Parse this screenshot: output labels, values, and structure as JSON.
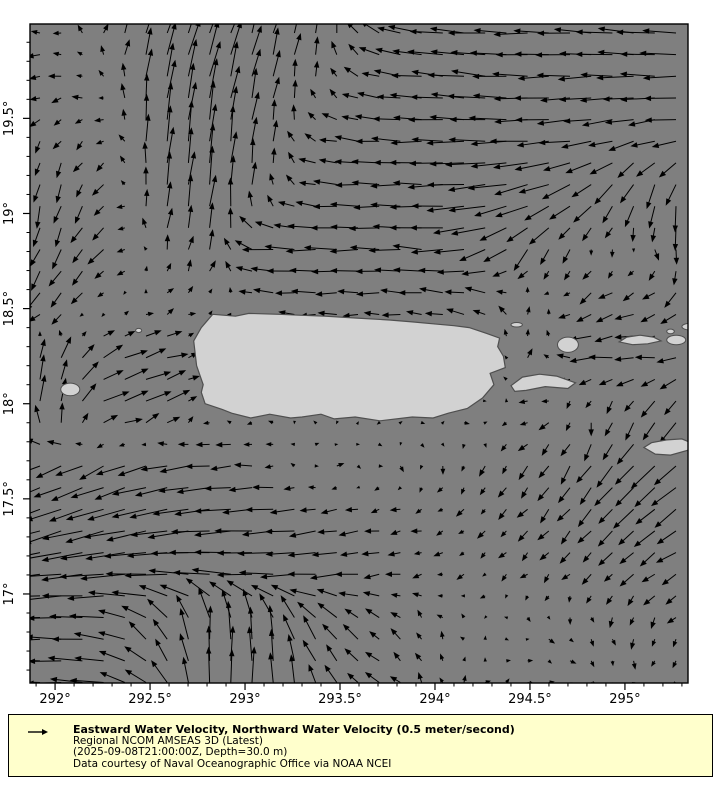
{
  "map": {
    "plot": {
      "x": 30,
      "y": 24,
      "w": 658,
      "h": 659
    },
    "extent": {
      "lon_min": 291.868,
      "lon_max": 295.332,
      "lat_min": 16.532,
      "lat_max": 19.996
    },
    "colors": {
      "ocean": "#7f7f7f",
      "land": "#d2d2d2",
      "coast": "#4f4f4f",
      "frame": "#000000",
      "arrow": "#000000",
      "tick_label": "#000000"
    }
  },
  "axes": {
    "x_ticks": [
      {
        "v": 292.0,
        "label": "292°"
      },
      {
        "v": 292.5,
        "label": "292.5°"
      },
      {
        "v": 293.0,
        "label": "293°"
      },
      {
        "v": 293.5,
        "label": "293.5°"
      },
      {
        "v": 294.0,
        "label": "294°"
      },
      {
        "v": 294.5,
        "label": "294.5°"
      },
      {
        "v": 295.0,
        "label": "295°"
      }
    ],
    "y_ticks": [
      {
        "v": 19.5,
        "label": "19.5°"
      },
      {
        "v": 19.0,
        "label": "19°"
      },
      {
        "v": 18.5,
        "label": "18.5°"
      },
      {
        "v": 18.0,
        "label": "18°"
      },
      {
        "v": 17.5,
        "label": "17.5°"
      },
      {
        "v": 17.0,
        "label": "17°"
      }
    ],
    "minor_step": 0.1,
    "font_px": 13
  },
  "field": {
    "type": "quiver",
    "units": "meter/second",
    "lon0": 292.0,
    "dlon": 0.28,
    "lat0": 19.95,
    "dlat": -0.285,
    "cols": 13,
    "rows": 13,
    "scale_px_per_ms": 42,
    "grid_spacing_px": {
      "x": 21.2,
      "y": 21.65
    },
    "u": [
      [
        -0.25,
        0.1,
        0.25,
        0.3,
        0.2,
        0.1,
        -0.4,
        -0.8,
        -0.85,
        -0.8,
        -0.85,
        -0.9,
        -0.8
      ],
      [
        -0.3,
        -0.15,
        0.15,
        0.2,
        0.15,
        -0.05,
        -0.45,
        -0.75,
        -0.85,
        -0.8,
        -0.75,
        -0.85,
        -0.8
      ],
      [
        -0.15,
        -0.2,
        0.1,
        0.1,
        0.1,
        -0.35,
        -0.6,
        -0.75,
        -0.9,
        -0.85,
        -0.7,
        -0.55,
        -0.65
      ],
      [
        -0.1,
        -0.25,
        0.1,
        0.1,
        0.0,
        -0.5,
        -0.65,
        -0.75,
        -0.95,
        -0.8,
        -0.5,
        -0.2,
        -0.05
      ],
      [
        -0.2,
        -0.35,
        0.05,
        0.1,
        -0.7,
        -0.75,
        -0.7,
        -0.75,
        -0.7,
        -0.3,
        -0.05,
        0.05,
        0.05
      ],
      [
        -0.35,
        -0.1,
        0.15,
        0.1,
        -0.4,
        -0.5,
        -0.45,
        -0.5,
        -0.45,
        0.1,
        -0.35,
        -0.4,
        -0.3
      ],
      [
        0.15,
        0.5,
        0.55,
        -0.1,
        -0.1,
        -0.1,
        -0.1,
        -0.1,
        -0.15,
        0.1,
        -0.55,
        -0.5,
        -0.4
      ],
      [
        0.05,
        0.65,
        0.6,
        -0.05,
        -0.05,
        -0.05,
        -0.05,
        0.1,
        0.15,
        -0.3,
        0.05,
        -0.2,
        -0.35
      ],
      [
        -0.6,
        -0.65,
        -0.7,
        -0.6,
        -0.3,
        0.15,
        0.1,
        0.0,
        -0.1,
        -0.2,
        -0.3,
        -0.5,
        -0.6
      ],
      [
        -0.85,
        -0.95,
        -0.9,
        -0.95,
        -0.8,
        -0.55,
        -0.35,
        -0.2,
        -0.15,
        -0.25,
        -0.3,
        -0.45,
        -0.55
      ],
      [
        -1.0,
        -1.05,
        -1.0,
        -0.9,
        -0.85,
        -0.7,
        -0.45,
        -0.2,
        -0.1,
        -0.15,
        -0.2,
        -0.3,
        -0.4
      ],
      [
        -0.8,
        -0.7,
        -0.35,
        0.0,
        -0.1,
        -0.4,
        -0.3,
        -0.1,
        -0.05,
        0.1,
        0.1,
        -0.05,
        -0.15
      ],
      [
        -0.85,
        -0.75,
        -0.4,
        0.05,
        0.0,
        -0.2,
        -0.35,
        -0.1,
        0.1,
        0.15,
        0.1,
        0.0,
        -0.1
      ]
    ],
    "v": [
      [
        0.0,
        0.3,
        0.75,
        0.8,
        0.7,
        0.5,
        0.25,
        0.1,
        0.05,
        0.0,
        0.05,
        0.08,
        0.0
      ],
      [
        -0.05,
        0.1,
        0.85,
        0.9,
        0.6,
        0.25,
        0.1,
        0.05,
        0.1,
        0.0,
        -0.05,
        0.0,
        0.0
      ],
      [
        -0.25,
        -0.1,
        0.9,
        0.95,
        0.5,
        0.1,
        0.05,
        0.0,
        0.0,
        -0.05,
        -0.1,
        -0.2,
        -0.05
      ],
      [
        -0.5,
        -0.25,
        0.7,
        0.9,
        0.3,
        0.05,
        0.0,
        0.0,
        -0.1,
        -0.25,
        -0.4,
        -0.6,
        -0.7
      ],
      [
        -0.45,
        -0.3,
        0.3,
        0.45,
        0.05,
        0.0,
        0.0,
        0.05,
        -0.2,
        -0.5,
        -0.2,
        -0.1,
        -0.55
      ],
      [
        -0.4,
        -0.05,
        0.1,
        0.05,
        0.05,
        0.0,
        0.0,
        0.05,
        0.15,
        0.25,
        -0.25,
        -0.15,
        -0.35
      ],
      [
        0.5,
        0.25,
        0.15,
        0.02,
        0.0,
        0.0,
        0.0,
        0.0,
        0.02,
        0.2,
        -0.05,
        0.0,
        -0.1
      ],
      [
        0.65,
        0.2,
        0.3,
        0.02,
        0.0,
        0.0,
        0.0,
        0.05,
        0.05,
        -0.05,
        -0.25,
        -0.4,
        -0.5
      ],
      [
        -0.25,
        -0.3,
        -0.15,
        -0.05,
        0.0,
        0.05,
        -0.05,
        -0.15,
        -0.2,
        -0.3,
        -0.45,
        -0.5,
        -0.5
      ],
      [
        -0.3,
        -0.25,
        -0.2,
        -0.1,
        -0.05,
        -0.1,
        -0.05,
        -0.05,
        -0.15,
        -0.25,
        -0.35,
        -0.4,
        -0.35
      ],
      [
        -0.1,
        -0.1,
        0.0,
        0.1,
        0.0,
        -0.05,
        -0.05,
        -0.05,
        -0.1,
        -0.15,
        -0.2,
        -0.25,
        -0.2
      ],
      [
        0.0,
        0.1,
        0.5,
        0.9,
        0.8,
        0.5,
        0.25,
        0.2,
        0.05,
        -0.05,
        -0.15,
        -0.25,
        -0.15
      ],
      [
        0.0,
        0.1,
        0.45,
        0.85,
        0.8,
        0.45,
        0.2,
        0.2,
        0.1,
        0.0,
        -0.1,
        -0.15,
        -0.1
      ]
    ]
  },
  "land": {
    "puerto_rico": [
      [
        292.83,
        18.47
      ],
      [
        292.95,
        18.46
      ],
      [
        293.02,
        18.475
      ],
      [
        293.18,
        18.47
      ],
      [
        293.3,
        18.465
      ],
      [
        293.42,
        18.46
      ],
      [
        293.59,
        18.45
      ],
      [
        293.76,
        18.44
      ],
      [
        293.88,
        18.43
      ],
      [
        293.99,
        18.42
      ],
      [
        294.1,
        18.41
      ],
      [
        294.18,
        18.4
      ],
      [
        294.27,
        18.37
      ],
      [
        294.34,
        18.345
      ],
      [
        294.33,
        18.3
      ],
      [
        294.36,
        18.25
      ],
      [
        294.37,
        18.19
      ],
      [
        294.29,
        18.16
      ],
      [
        294.31,
        18.1
      ],
      [
        294.25,
        18.03
      ],
      [
        294.17,
        17.975
      ],
      [
        294.07,
        17.95
      ],
      [
        293.99,
        17.925
      ],
      [
        293.88,
        17.93
      ],
      [
        293.71,
        17.91
      ],
      [
        293.58,
        17.93
      ],
      [
        293.47,
        17.92
      ],
      [
        293.4,
        17.945
      ],
      [
        293.3,
        17.93
      ],
      [
        293.24,
        17.925
      ],
      [
        293.13,
        17.945
      ],
      [
        293.03,
        17.925
      ],
      [
        292.93,
        17.95
      ],
      [
        292.88,
        17.97
      ],
      [
        292.79,
        18.0
      ],
      [
        292.77,
        18.06
      ],
      [
        292.78,
        18.1
      ],
      [
        292.745,
        18.2
      ],
      [
        292.73,
        18.33
      ],
      [
        292.77,
        18.4
      ]
    ],
    "vieques": [
      [
        294.4,
        18.095
      ],
      [
        294.46,
        18.14
      ],
      [
        294.55,
        18.155
      ],
      [
        294.64,
        18.145
      ],
      [
        294.74,
        18.11
      ],
      [
        294.7,
        18.08
      ],
      [
        294.58,
        18.09
      ],
      [
        294.48,
        18.07
      ],
      [
        294.42,
        18.065
      ]
    ],
    "st_thomas": [
      [
        294.97,
        18.325
      ],
      [
        295.01,
        18.35
      ],
      [
        295.08,
        18.36
      ],
      [
        295.15,
        18.35
      ],
      [
        295.19,
        18.33
      ],
      [
        295.12,
        18.315
      ],
      [
        295.04,
        18.31
      ]
    ],
    "st_croix": [
      [
        295.1,
        17.77
      ],
      [
        295.14,
        17.795
      ],
      [
        295.22,
        17.81
      ],
      [
        295.3,
        17.815
      ],
      [
        295.36,
        17.79
      ],
      [
        295.33,
        17.755
      ],
      [
        295.24,
        17.73
      ],
      [
        295.16,
        17.735
      ]
    ],
    "ellipse_islands": [
      {
        "name": "mona",
        "cx": 292.08,
        "cy": 18.075,
        "rx": 0.05,
        "ry": 0.033
      },
      {
        "name": "desecheo",
        "cx": 292.44,
        "cy": 18.385,
        "rx": 0.016,
        "ry": 0.011
      },
      {
        "name": "culebra",
        "cx": 294.7,
        "cy": 18.31,
        "rx": 0.055,
        "ry": 0.04
      },
      {
        "name": "icacos-cays",
        "cx": 294.43,
        "cy": 18.415,
        "rx": 0.03,
        "ry": 0.012
      },
      {
        "name": "st-john",
        "cx": 295.27,
        "cy": 18.335,
        "rx": 0.05,
        "ry": 0.025
      },
      {
        "name": "jost-van-dyke",
        "cx": 295.24,
        "cy": 18.38,
        "rx": 0.02,
        "ry": 0.012
      },
      {
        "name": "tortola",
        "cx": 295.345,
        "cy": 18.405,
        "rx": 0.045,
        "ry": 0.018
      }
    ]
  },
  "legend": {
    "line1": "Eastward Water Velocity, Northward Water Velocity (0.5 meter/second)",
    "line2": "Regional NCOM AMSEAS 3D (Latest)",
    "line3": "(2025-09-08T21:00:00Z, Depth=30.0 m)",
    "line4": "Data courtesy of Naval Oceanographic Office via NOAA NCEI",
    "ref_speed_ms": 0.5,
    "bg_color": "#ffffcc",
    "border_color": "#000000",
    "text_color": "#000000"
  }
}
